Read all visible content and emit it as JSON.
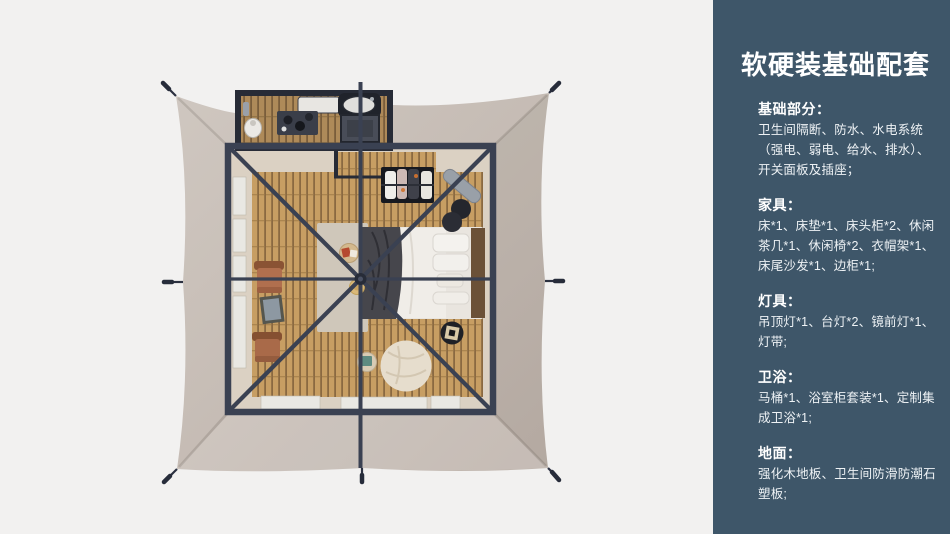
{
  "panel": {
    "title": "软硬装基础配套",
    "sections": [
      {
        "heading": "基础部分：",
        "body": "卫生间隔断、防水、水电系统（强电、弱电、给水、排水）、开关面板及插座；"
      },
      {
        "heading": "家具：",
        "body": "床*1、床垫*1、床头柜*2、休闲茶几*1、休闲椅*2、衣帽架*1、床尾沙发*1、边柜*1;"
      },
      {
        "heading": "灯具：",
        "body": "吊顶灯*1、台灯*2、镜前灯*1、灯带;"
      },
      {
        "heading": "卫浴：",
        "body": "马桶*1、浴室柜套装*1、定制集成卫浴*1;"
      },
      {
        "heading": "地面：",
        "body": "强化木地板、卫生间防滑防潮石塑板;"
      }
    ]
  },
  "illustration": {
    "colors": {
      "page-bg": "#f2f1f0",
      "panel-bg": "#3e5669",
      "panel-text": "#eef2f5",
      "canvas-light": "#cfc7c0",
      "canvas-dark": "#bcb1a9",
      "frame": "#3a4152",
      "floor-beige": "#dbd1c3",
      "wood-light": "#c79e63",
      "wood-dark": "#8a6941",
      "pod-wall": "#272b36"
    }
  }
}
